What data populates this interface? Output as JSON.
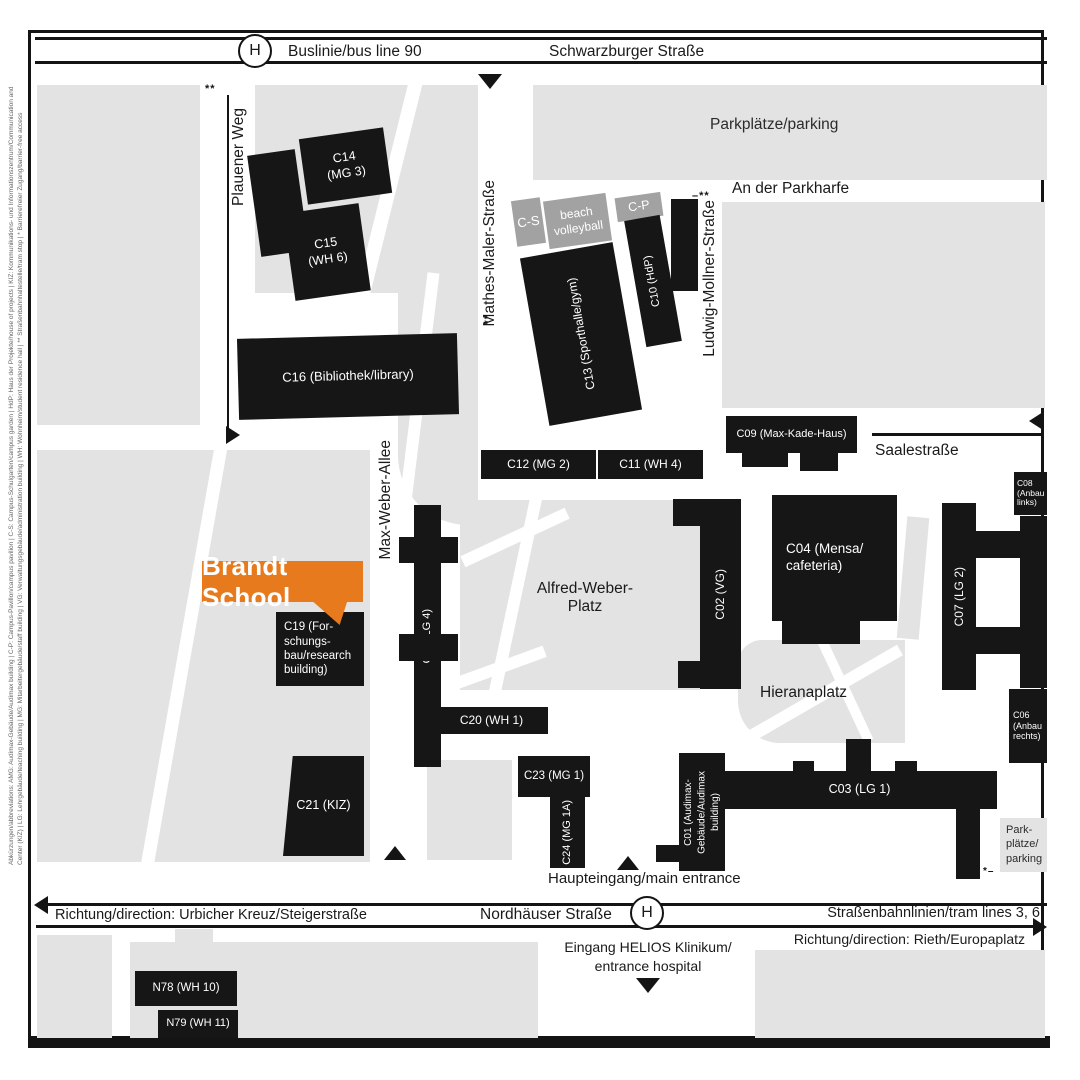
{
  "colors": {
    "building_black": "#161616",
    "building_gray": "#a2a2a2",
    "area_gray": "#e3e3e3",
    "highlight_orange": "#E87A1E"
  },
  "top_road": {
    "stop": "H",
    "bus_line": "Buslinie/bus line 90",
    "street": "Schwarzburger Straße"
  },
  "streets": {
    "plauener_weg": "Plauener Weg",
    "mathes_maler": "Mathes-Maler-Straße",
    "ludwig_mollner": "Ludwig-Mollner-Straße",
    "an_der_parkharfe": "An der Parkharfe",
    "saalestrasse": "Saalestraße",
    "max_weber_allee": "Max-Weber-Allee"
  },
  "areas": {
    "parking_top": "Parkplätze/parking",
    "parking_bottom": "Park-\nplätze/\nparking",
    "alfred_weber_platz": "Alfred-Weber-\nPlatz",
    "hieranaplatz": "Hieranaplatz"
  },
  "gray_buildings": {
    "cs": "C-S",
    "beach": "beach\nvolleyball",
    "cp": "C-P"
  },
  "buildings": {
    "c14": "C14\n(MG 3)",
    "c15": "C15\n(WH 6)",
    "c16": "C16 (Bibliothek/library)",
    "c13": "C13 (Sporthalle/gym)",
    "c10": "C10 (HdP)",
    "c09": "C09 (Max-Kade-Haus)",
    "c12": "C12 (MG 2)",
    "c11": "C11 (WH 4)",
    "c18": "C18 (LG 4)",
    "c19": "C19 (For-\nschungs-\nbau/research\nbuilding)",
    "c02": "C02 (VG)",
    "c04": "C04 (Mensa/\ncafeteria)",
    "c07": "C07 (LG 2)",
    "c08": "C08\n(Anbau\nlinks)",
    "c06": "C06\n(Anbau\nrechts)",
    "c20": "C20 (WH 1)",
    "c21": "C21 (KIZ)",
    "c23": "C23 (MG 1)",
    "c24": "C24 (MG 1A)",
    "c01": "C01 (Audimax-\nGebäude/Audimax\nbuilding)",
    "c03": "C03 (LG 1)",
    "n78": "N78 (WH 10)",
    "n79": "N79 (WH 11)"
  },
  "highlight": {
    "label": "Brandt School"
  },
  "entrances": {
    "main": "Haupteingang/main entrance",
    "helios": "Eingang HELIOS Klinikum/\nentrance hospital"
  },
  "bottom_road": {
    "direction_left": "Richtung/direction: Urbicher Kreuz/Steigerstraße",
    "street": "Nordhäuser Straße",
    "stop": "H",
    "tram": "Straßenbahnlinien/tram lines 3, 6",
    "direction_right": "Richtung/direction: Rieth/Europaplatz"
  },
  "marks": {
    "tram": "**",
    "dash_tram": "–**",
    "access": "*–"
  },
  "legend": {
    "line1": "Abkürzungen/abbreviations: AMG: Audimax-Gebäude/Audimax building | C-P: Campus-Pavillon/campus pavilion | C-S: Campus-Schulgarten/campus garden | HdP: Haus der Projekte/house of projects | KIZ: Kommunikations- und Informationszentrum/Communication and Information",
    "line2": "Center (KIZ) | LG: Lehrgebäude/teaching building | MG: Mitarbeitergebäude/staff building | VG: Verwaltungsgebäude/administration building | WH: Wohnheim/student residence hall | ** Straßenbahnhaltestelle/tram stop | * Barrierefreier Zugang/barrier-free access"
  }
}
